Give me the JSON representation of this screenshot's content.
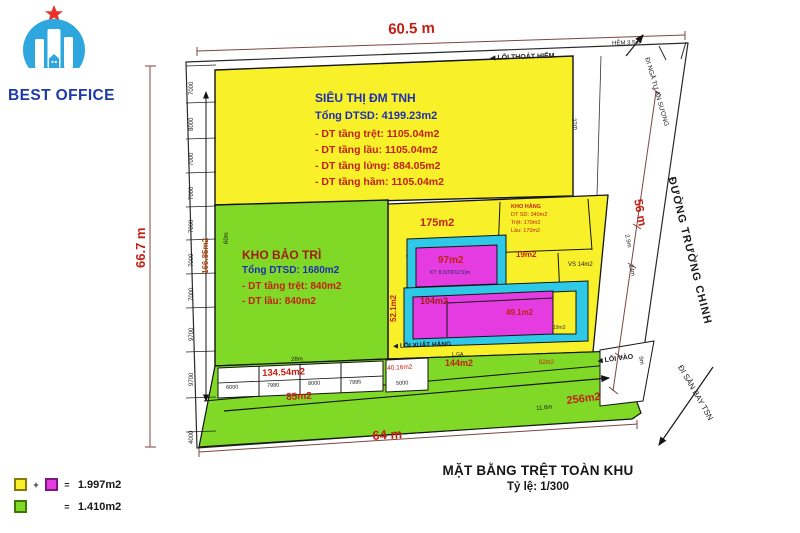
{
  "logo": {
    "brand": "BEST OFFICE"
  },
  "dims": {
    "top": "60.5 m",
    "left": "66.7 m",
    "right": "56 m",
    "bottom": "64 m",
    "hem": "HẺM 3.5m",
    "w22": "22m",
    "w29": "2.9m",
    "w24": "24m",
    "w9": "9m",
    "w28": "28m",
    "w60": "60m",
    "w116": "11.6m",
    "span": "166.85m2"
  },
  "streets": {
    "main": "ĐƯỜNG TRƯỜNG CHINH",
    "north": "ĐI NGÃ TƯ AN SƯƠNG",
    "south": "ĐI SÂN BAY TSN"
  },
  "access": {
    "emergency": "◀ LỐI THOÁT HIỂM",
    "goods": "◀ LỐI XUẤT HÀNG",
    "entry": "◀ LỐI VÀO"
  },
  "supermarket": {
    "name": "SIÊU THỊ ĐM TNH",
    "total": "Tổng DTSD: 4199.23m2",
    "floor1": "- DT tầng trệt: 1105.04m2",
    "floor2": "- DT tầng lầu: 1105.04m2",
    "floor3": "- DT tầng lửng: 884.05m2",
    "floor4": "- DT tầng hầm: 1105.04m2"
  },
  "maintenance": {
    "name": "KHO BẢO TRÌ",
    "total": "Tổng DTSD: 1680m2",
    "floor1": "- DT tầng trệt: 840m2",
    "floor2": "- DT lầu: 840m2"
  },
  "storage": {
    "line1": "KHO HÀNG",
    "line2": "DT SD: 340m2",
    "line3": "Trệt: 170m2",
    "line4": "Lầu: 170m2"
  },
  "areas": {
    "a175": "175m2",
    "a97": "97m2",
    "a97note": "KT: 8.0(T8/12.5)m",
    "a104": "104m2",
    "a49": "49.1m2",
    "a19": "19m2",
    "a19b": "19m2",
    "a52": "52.1m2",
    "a134": "134.54m2",
    "a85": "85m2",
    "a256": "256m2",
    "a40": "40.16m2",
    "a144": "144m2",
    "lga": "L.GA",
    "a62": "62m2",
    "vs": "VS 14m2"
  },
  "ticks": {
    "left": [
      "7000",
      "8000",
      "7000",
      "7000",
      "7000",
      "7000",
      "7000",
      "9700",
      "9700",
      "4000"
    ],
    "cells": [
      "6000",
      "7980",
      "8000",
      "7995"
    ],
    "c5000": "5000"
  },
  "titleblock": {
    "title": "MẶT BẰNG TRỆT TOÀN KHU",
    "scale": "Tỷ lệ: 1/300"
  },
  "legend": {
    "v1": "1.997m2",
    "v2": "1.410m2",
    "plus": "+",
    "eq": "="
  }
}
